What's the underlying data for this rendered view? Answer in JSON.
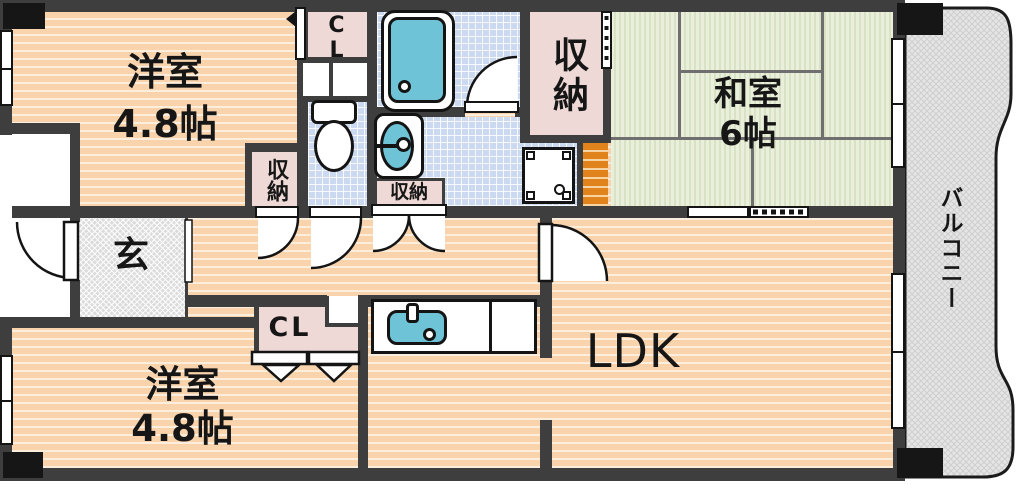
{
  "plan": {
    "rooms": {
      "west_room_top": {
        "name": "洋室",
        "size": "4.8帖"
      },
      "west_room_bottom": {
        "name": "洋室",
        "size": "4.8帖"
      },
      "japanese_room": {
        "name": "和室",
        "size": "6帖"
      },
      "ldk": {
        "name": "LDK"
      },
      "balcony": {
        "name": "バルコニー"
      },
      "entrance": {
        "name": "玄"
      }
    },
    "closets": {
      "cl_top": "CL",
      "cl_bottom": "CL",
      "storage_hall": "収納",
      "storage_upper_right": "収納",
      "storage_washroom": "収納"
    },
    "colors": {
      "wall": "#3e3e3e",
      "floor_peach": "#f8d3ac",
      "floor_stripe": "#fceedd",
      "tile_blue": "#cbd9f1",
      "tatami_green": "#e9efdb",
      "fixture_cyan": "#6fc3d6",
      "closet_pink": "#eed9d6",
      "board_orange": "#e0831c",
      "balcony_gray": "#e5e5e5",
      "entry_gray": "#dcdcdc"
    }
  }
}
